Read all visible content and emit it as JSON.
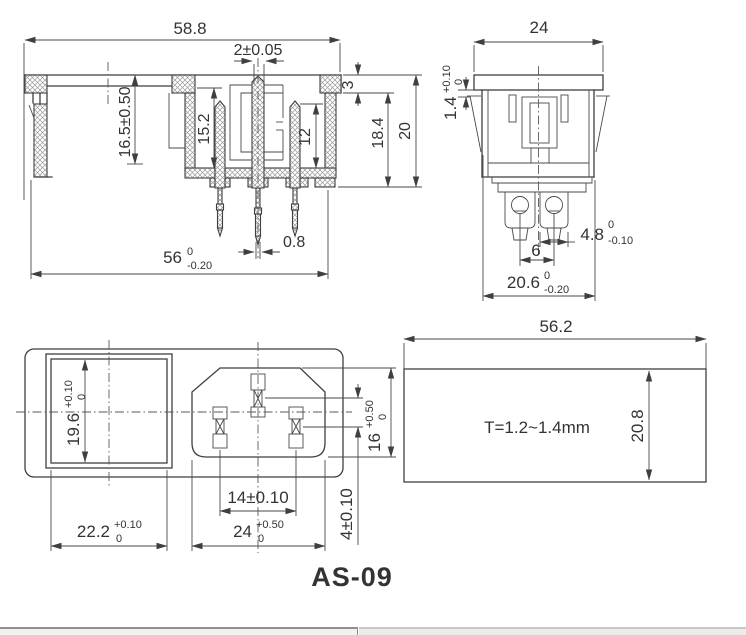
{
  "title": "AS-09",
  "views": {
    "side": {
      "w_top": "58.8",
      "pin_w": "2±0.05",
      "step": "3",
      "depth_in": "18.4",
      "depth": "20",
      "h_left": "16.5±0.50",
      "recess": "15.2",
      "pin_len": "12",
      "tip_w": "0.8",
      "w_bot": "56",
      "w_bot_t1": "0",
      "w_bot_t2": "-0.20"
    },
    "end": {
      "w": "24",
      "gap": "1.4",
      "gap_t1": "+0.10",
      "gap_t2": "0",
      "term": "4.8",
      "term_t1": "0",
      "term_t2": "-0.10",
      "pitch": "6",
      "body": "20.6",
      "body_t1": "0",
      "body_t2": "-0.20"
    },
    "face": {
      "sq_h": "19.6",
      "sq_h_t1": "+0.10",
      "sq_h_t2": "0",
      "sq_w": "22.2",
      "sq_w_t1": "+0.10",
      "sq_w_t2": "0",
      "pin_pitch": "14±0.10",
      "in_w": "24",
      "in_w_t1": "+0.50",
      "in_w_t2": "0",
      "in_h": "16",
      "in_h_t1": "+0.50",
      "in_h_t2": "0",
      "pin_off": "4±0.10"
    },
    "panel": {
      "w": "56.2",
      "h": "20.8",
      "note": "T=1.2~1.4mm"
    }
  }
}
